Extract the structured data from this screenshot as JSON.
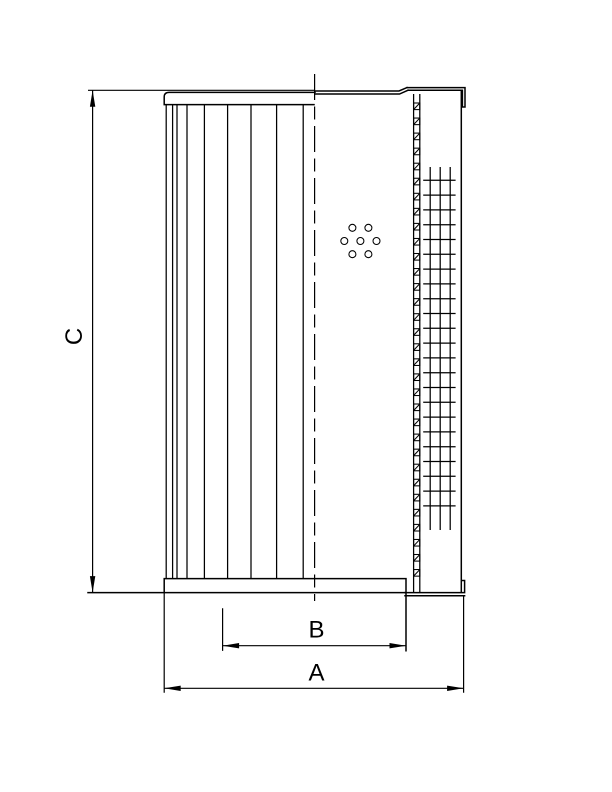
{
  "page": {
    "background": "#ffffff",
    "line_color": "#000000",
    "description_labels_visible": [
      "C",
      "B",
      "A"
    ]
  },
  "dimensions": {
    "c": {
      "label": "C"
    },
    "b": {
      "label": "B"
    },
    "a": {
      "label": "A"
    }
  },
  "drawing": {
    "pleats": {
      "line_x": [
        166.2,
        172.6,
        177.0,
        187.0,
        204.4,
        227.6,
        251.0,
        276.6,
        303.2
      ],
      "top_y": 104.6,
      "bottom_y": 578.6
    },
    "perforated_tube": {
      "x1": 413.6,
      "x2": 419.8,
      "top": 94,
      "bottom": 592,
      "square_start_y": 103,
      "square_step": 15.05,
      "square_h": 6.6
    },
    "mesh": {
      "vertical_x": [
        430.2,
        440.2,
        450.2
      ],
      "vertical_top": 167,
      "vertical_bottom": 530,
      "h_x1": 423.2,
      "h_x2": 455.6,
      "h_start_y": 180.3,
      "h_step": 14.8,
      "h_end_y": 516
    },
    "holes": {
      "radius": 3.5,
      "centers": [
        [
          352.4,
          227.8
        ],
        [
          368.4,
          227.8
        ],
        [
          344.3,
          241.0
        ],
        [
          360.4,
          241.0
        ],
        [
          376.5,
          241.0
        ],
        [
          352.4,
          254.2
        ],
        [
          368.4,
          254.2
        ]
      ]
    },
    "centerline": {
      "x": 314.6,
      "top": 74,
      "bottom": 601
    }
  }
}
